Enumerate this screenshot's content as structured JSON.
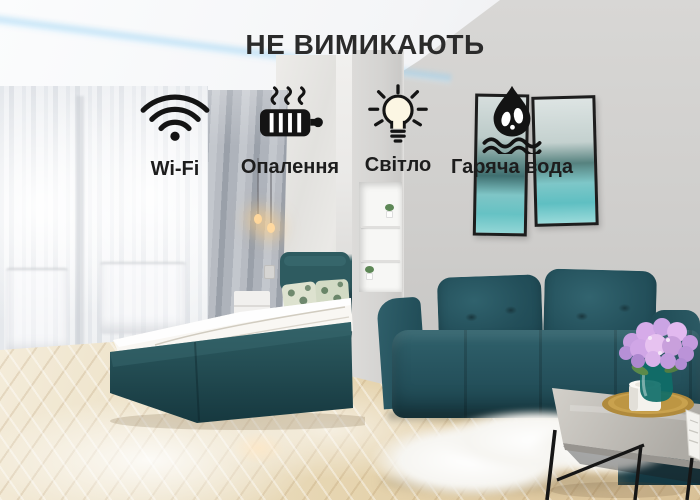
{
  "overlay": {
    "title": "НЕ ВИМИКАЮТЬ",
    "features": [
      {
        "icon": "wifi-icon",
        "label": "Wi-Fi"
      },
      {
        "icon": "radiator-icon",
        "label": "Опалення"
      },
      {
        "icon": "lightbulb-icon",
        "label": "Світло"
      },
      {
        "icon": "hot-water-icon",
        "label": "Гаряча вода"
      }
    ],
    "colors": {
      "title": "#2b2b2b",
      "label": "#1d1d1d",
      "icon": "#141414"
    }
  },
  "scene": {
    "colors": {
      "sofa_teal": "#27545f",
      "bed_teal": "#2a565c",
      "wall_gray": "#cecdcb",
      "partition_gray": "#d4d3d1",
      "floor_beige": "#e7d6b4",
      "picture_turquoise": "#6ec5c7",
      "flowers_lilac": "#c9a0dc",
      "tray_gold": "#c9a24e",
      "vase_teal": "#0f6e68",
      "led_blue": "#96d0f2",
      "curtain_gray": "#a8adb6",
      "bulb_glow": "#ffd9a0"
    }
  }
}
